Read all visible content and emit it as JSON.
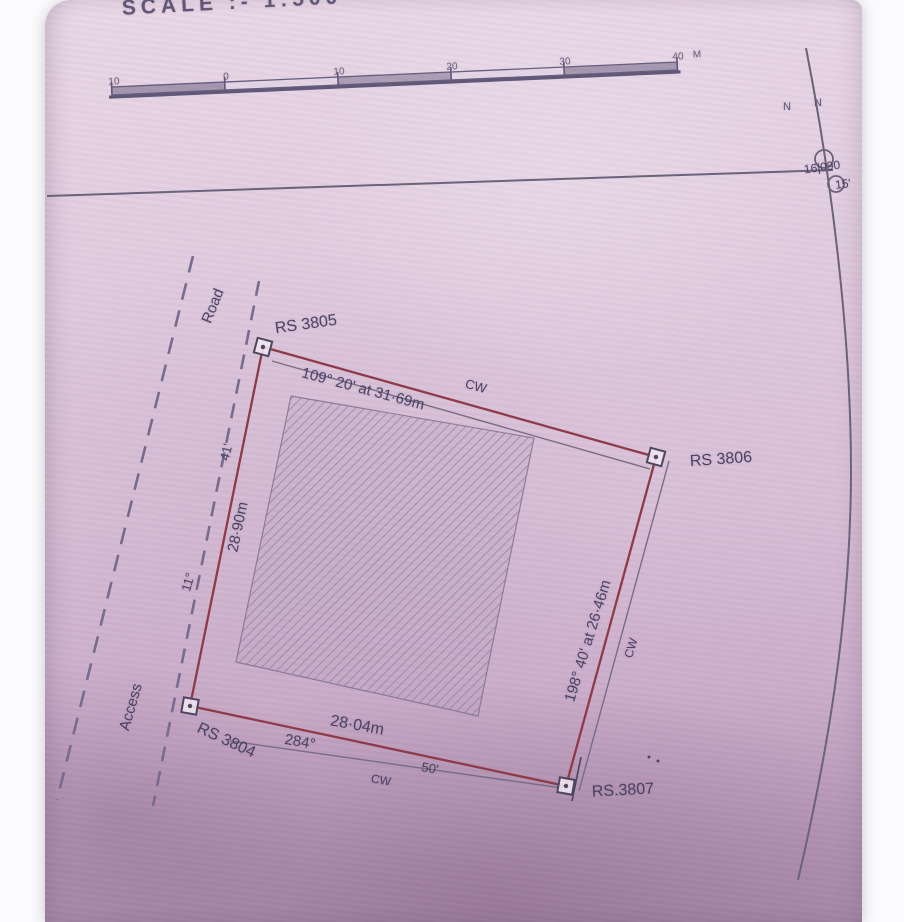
{
  "scale_title": "SCALE :- 1:500",
  "scale_bar": {
    "tick_labels": [
      "10",
      "0",
      "10",
      "20",
      "30",
      "40"
    ],
    "unit": "M"
  },
  "north_arrow": {
    "n_left": "N",
    "n_right": "N",
    "note_line1": "16|090",
    "note_line2": "15'"
  },
  "plot": {
    "corner_nw_label": "RS 3805",
    "corner_e_label": "RS 3806",
    "corner_se_label": "RS.3807",
    "corner_sw_label": "RS 3804",
    "edge_top_dimension": "109° 20' at 31·69m",
    "edge_top_wall": "CW",
    "edge_left_dimension": "28·90m",
    "edge_left_offset": "41'",
    "edge_left_angle": "11°",
    "edge_right_dimension": "198° 40' at 26·46m",
    "edge_right_wall": "CW",
    "edge_bottom_distance": "28·04m",
    "edge_bottom_bearing": "284°",
    "edge_bottom_minutes": "50'",
    "edge_bottom_wall": "CW"
  },
  "labels": {
    "road": "Road",
    "access": "Access"
  }
}
